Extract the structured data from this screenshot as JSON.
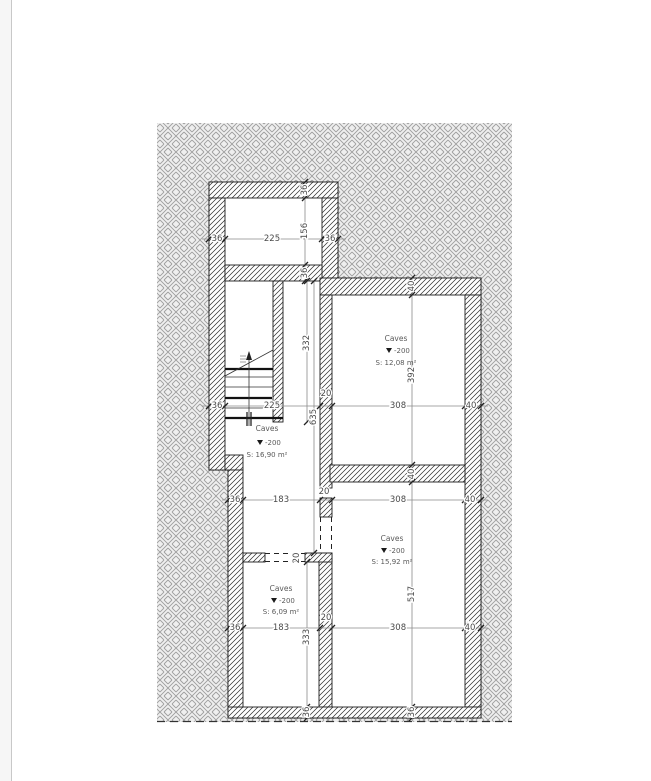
{
  "colors": {
    "page_bg": "#ffffff",
    "gutter_bg": "#f6f6f6",
    "gutter_line": "#c8c8c8",
    "site_hatch_line": "#9f9f9f",
    "site_hatch_bg": "#efefef",
    "wall_hatch_line": "#2b2b2b",
    "wall_outline": "#1c1c1c",
    "dim_line": "#8a8a8a",
    "dim_text": "#4a4a4a",
    "room_text": "#5a5a5a"
  },
  "rooms": [
    {
      "name": "Caves",
      "level": "-200",
      "area": "S: 12,08 m²"
    },
    {
      "name": "Caves",
      "level": "-200",
      "area": "S: 16,90 m²"
    },
    {
      "name": "Caves",
      "level": "-200",
      "area": "S: 15,92 m²"
    },
    {
      "name": "Caves",
      "level": "-200",
      "area": "S: 6,09 m²"
    }
  ],
  "dims": {
    "h_top": [
      "36",
      "225",
      "36"
    ],
    "v_top": [
      "36",
      "156",
      "36"
    ],
    "v_right": [
      "40",
      "392",
      "40",
      "517",
      "36"
    ],
    "v_left_mid": [
      "332",
      "635"
    ],
    "v_left_bottom": [
      "333",
      "36"
    ],
    "door_wall": "20",
    "h_mid": [
      "36",
      "225",
      "20",
      "308",
      "40"
    ],
    "h_lower": [
      "36",
      "183",
      "20",
      "308",
      "40"
    ],
    "h_bottom": [
      "36",
      "183",
      "20",
      "308",
      "40"
    ]
  }
}
